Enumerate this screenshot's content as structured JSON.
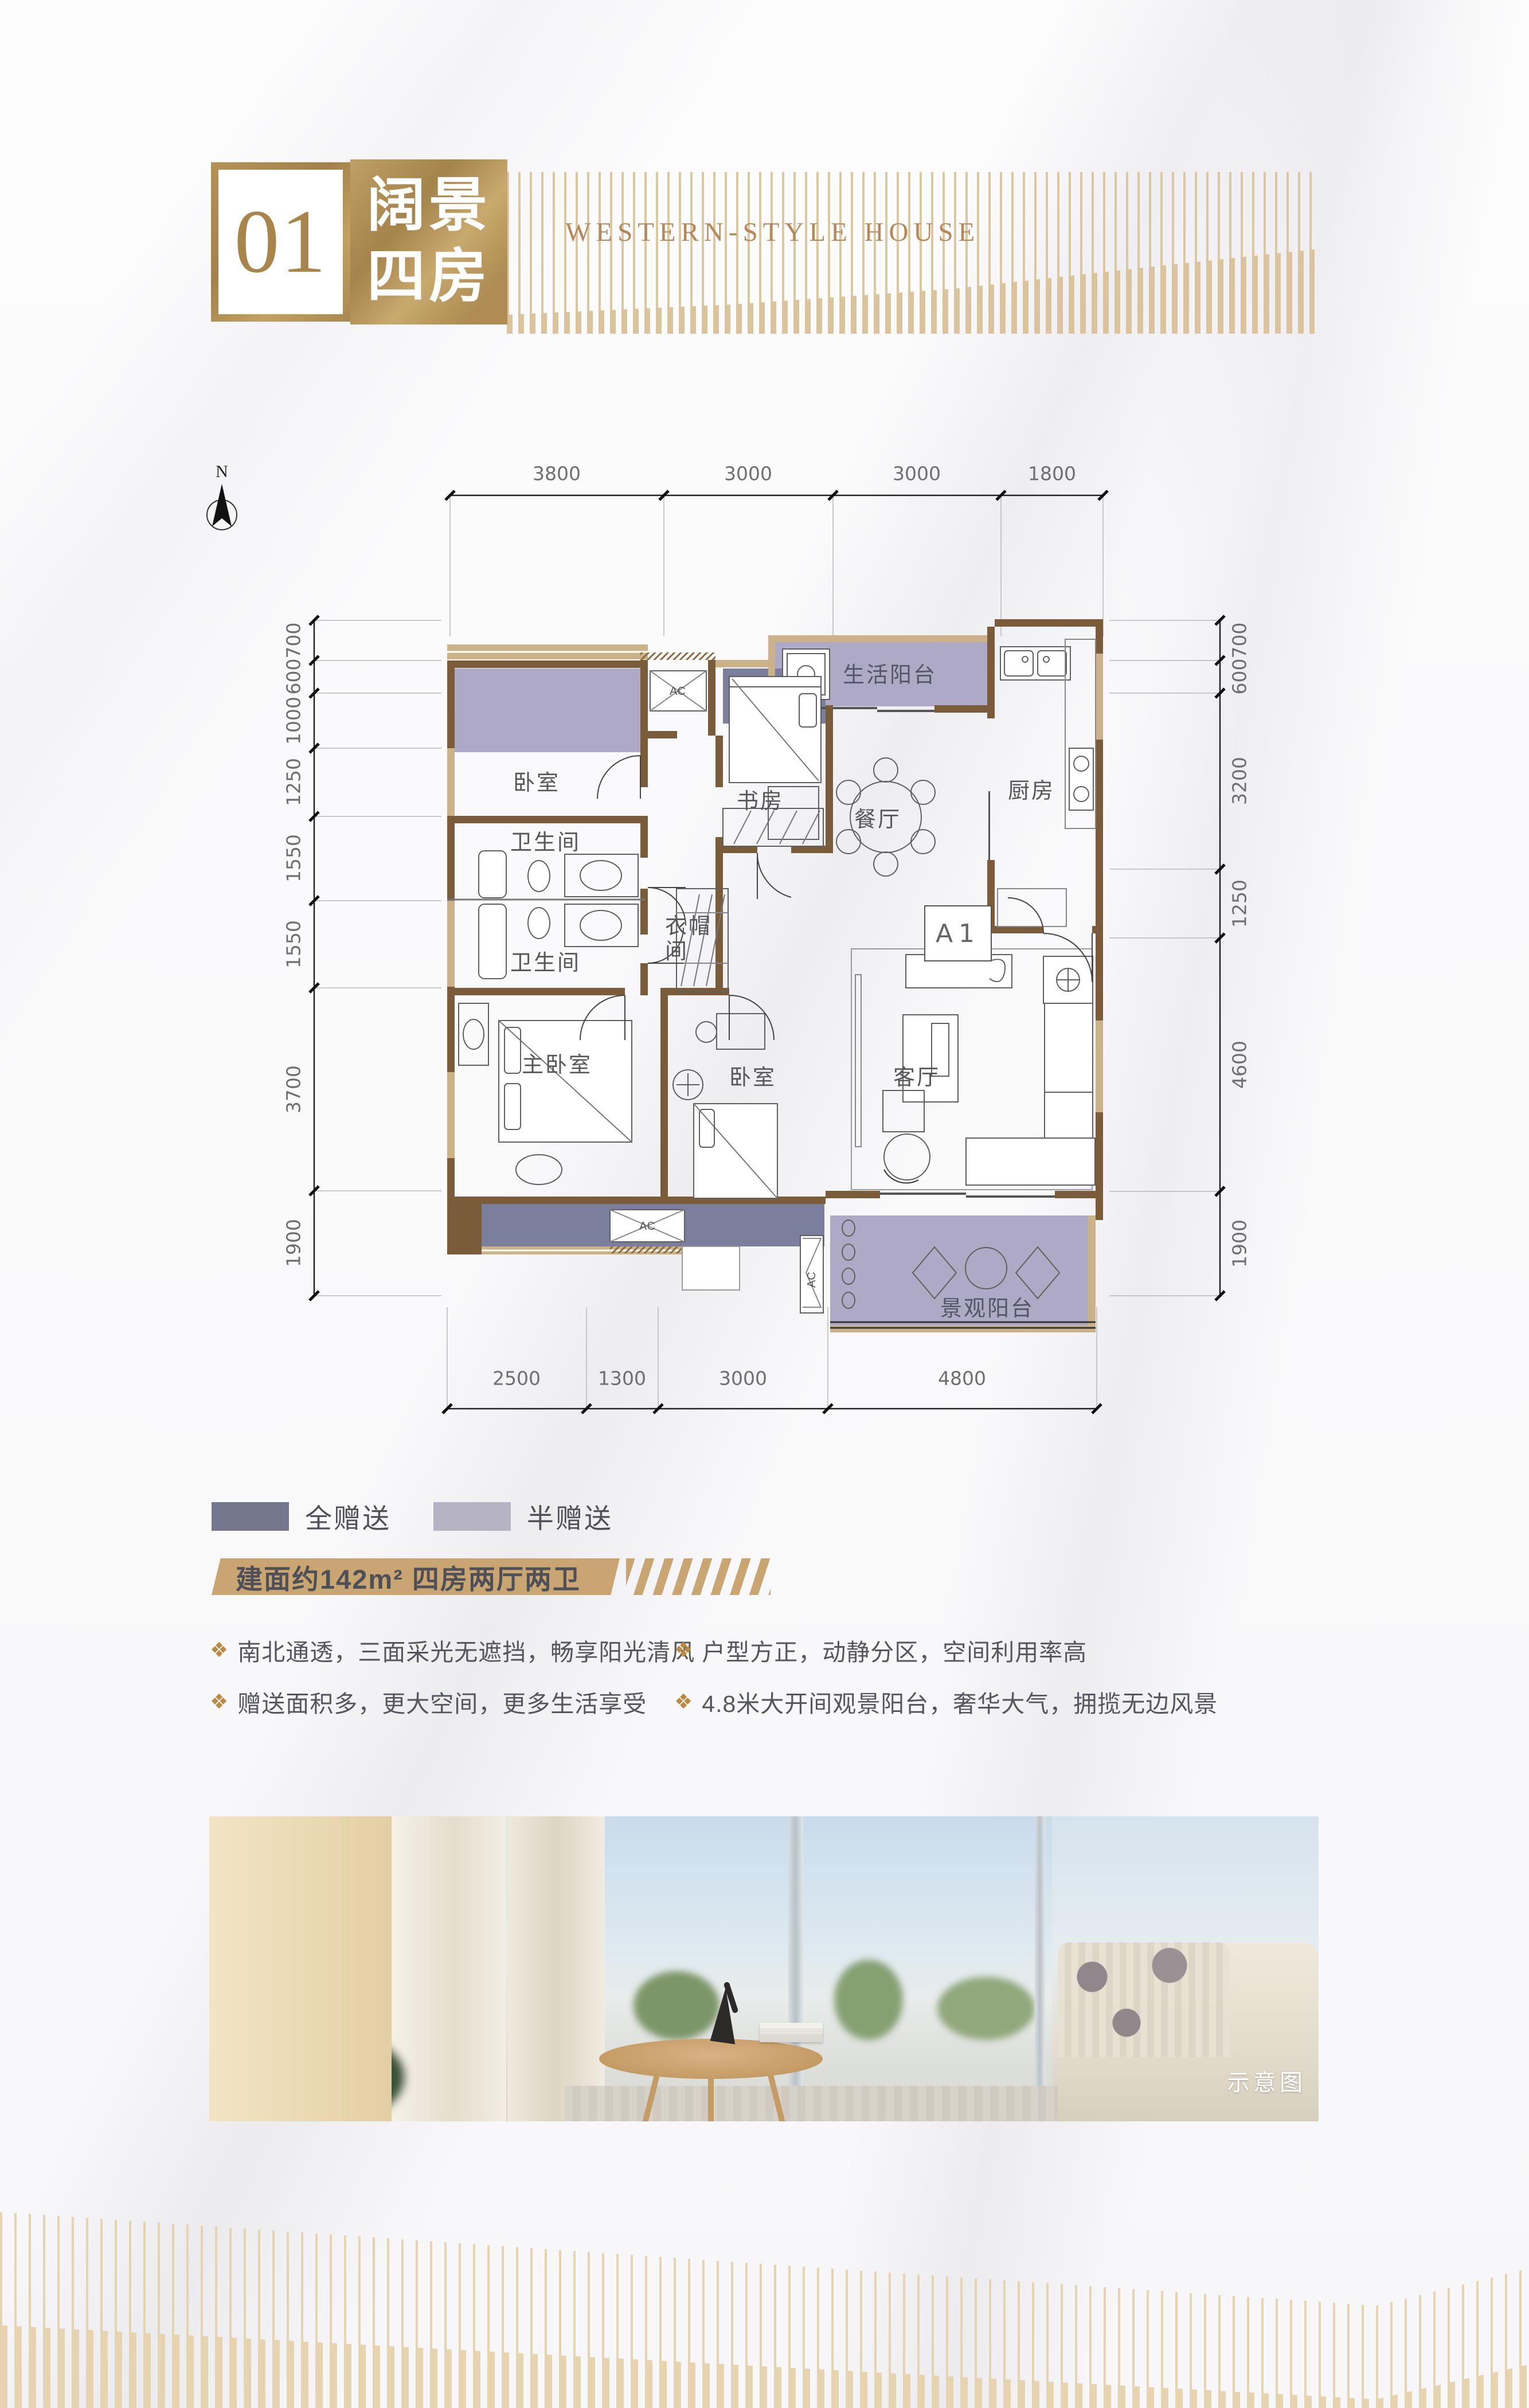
{
  "header": {
    "number": "01",
    "title_line1": "阔景",
    "title_line2": "四房",
    "subtitle": "WESTERN-STYLE HOUSE"
  },
  "compass": {
    "label": "N"
  },
  "plan": {
    "unit_label": "A1",
    "rooms": {
      "bedroom1": "卧室",
      "study": "书房",
      "life_balcony": "生活阳台",
      "kitchen": "厨房",
      "dining": "餐厅",
      "bath1": "卫生间",
      "bath2": "卫生间",
      "cloak_line1": "衣帽",
      "cloak_line2": "间",
      "master": "主卧室",
      "bedroom2": "卧室",
      "living": "客厅",
      "view_balcony": "景观阳台",
      "ac": "AC"
    },
    "dims": {
      "top": [
        "3800",
        "3000",
        "3000",
        "1800"
      ],
      "left": [
        "700",
        "600",
        "1000",
        "1250",
        "1550",
        "1550",
        "3700",
        "1900"
      ],
      "right": [
        "700",
        "600",
        "3200",
        "1250",
        "4600",
        "1900"
      ],
      "bottom": [
        "2500",
        "1300",
        "3000",
        "4800"
      ]
    }
  },
  "legend": {
    "full": {
      "label": "全赠送",
      "color": "#75778f"
    },
    "half": {
      "label": "半赠送",
      "color": "#b6b3c4"
    }
  },
  "banner": {
    "text": "建面约142m² 四房两厅两卫"
  },
  "features": {
    "bullet": "❖",
    "left": [
      "南北通透，三面采光无遮挡，畅享阳光清风",
      "赠送面积多，更大空间，更多生活享受"
    ],
    "right": [
      "户型方正，动静分区，空间利用率高",
      "4.8米大开间观景阳台，奢华大气，拥揽无边风景"
    ]
  },
  "photo": {
    "caption": "示意图"
  },
  "colors": {
    "accent_gold": "#c9a671",
    "stripe_gold": "#dcc7a1",
    "wall_brown": "#7b5c3a",
    "wall_tan": "#cbb288",
    "gift_full": "#7b7e9d",
    "gift_half": "#aeaac6",
    "text_dark": "#55565e"
  }
}
